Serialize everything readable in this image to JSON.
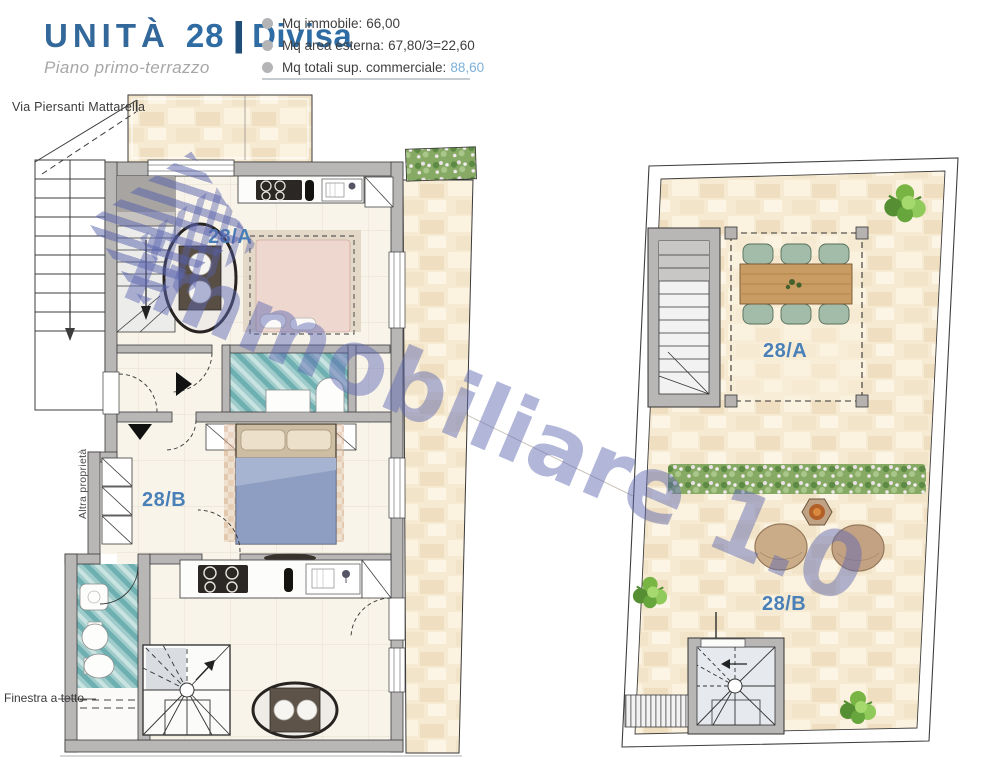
{
  "header": {
    "title": {
      "unit_word": "UNITÀ",
      "number": "28",
      "separator": "|",
      "name": "Divisa"
    },
    "subtitle": "Piano primo-terrazzo",
    "stats": [
      {
        "label": "Mq immobile:",
        "value": "66,00"
      },
      {
        "label": "Mq area esterna:",
        "value": "67,80/3=22,60"
      },
      {
        "label": "Mq totali sup. commerciale:",
        "value": "88,60"
      }
    ]
  },
  "floorplan": {
    "street_label": "Via Piersanti Mattarella",
    "adjacent_property_label": "Altra proprietà",
    "roof_window_label": "Finestra a tetto",
    "unit_a_label": "28/A",
    "unit_b_label": "28/B"
  },
  "terrace": {
    "unit_a_label": "28/A",
    "unit_b_label": "28/B"
  },
  "watermark": {
    "text": "immobiliare 1.0"
  },
  "colors": {
    "accent_blue": "#2e6ca3",
    "value_blue": "#7db0d8",
    "unit_label_blue": "#4a80b8",
    "watermark_blue": "#5f68b0",
    "wall_gray": "#b9b6b6",
    "floor_beige": "#f6ead2",
    "tile_teal": "#6eb0b1",
    "plant_green": "#76b043"
  }
}
